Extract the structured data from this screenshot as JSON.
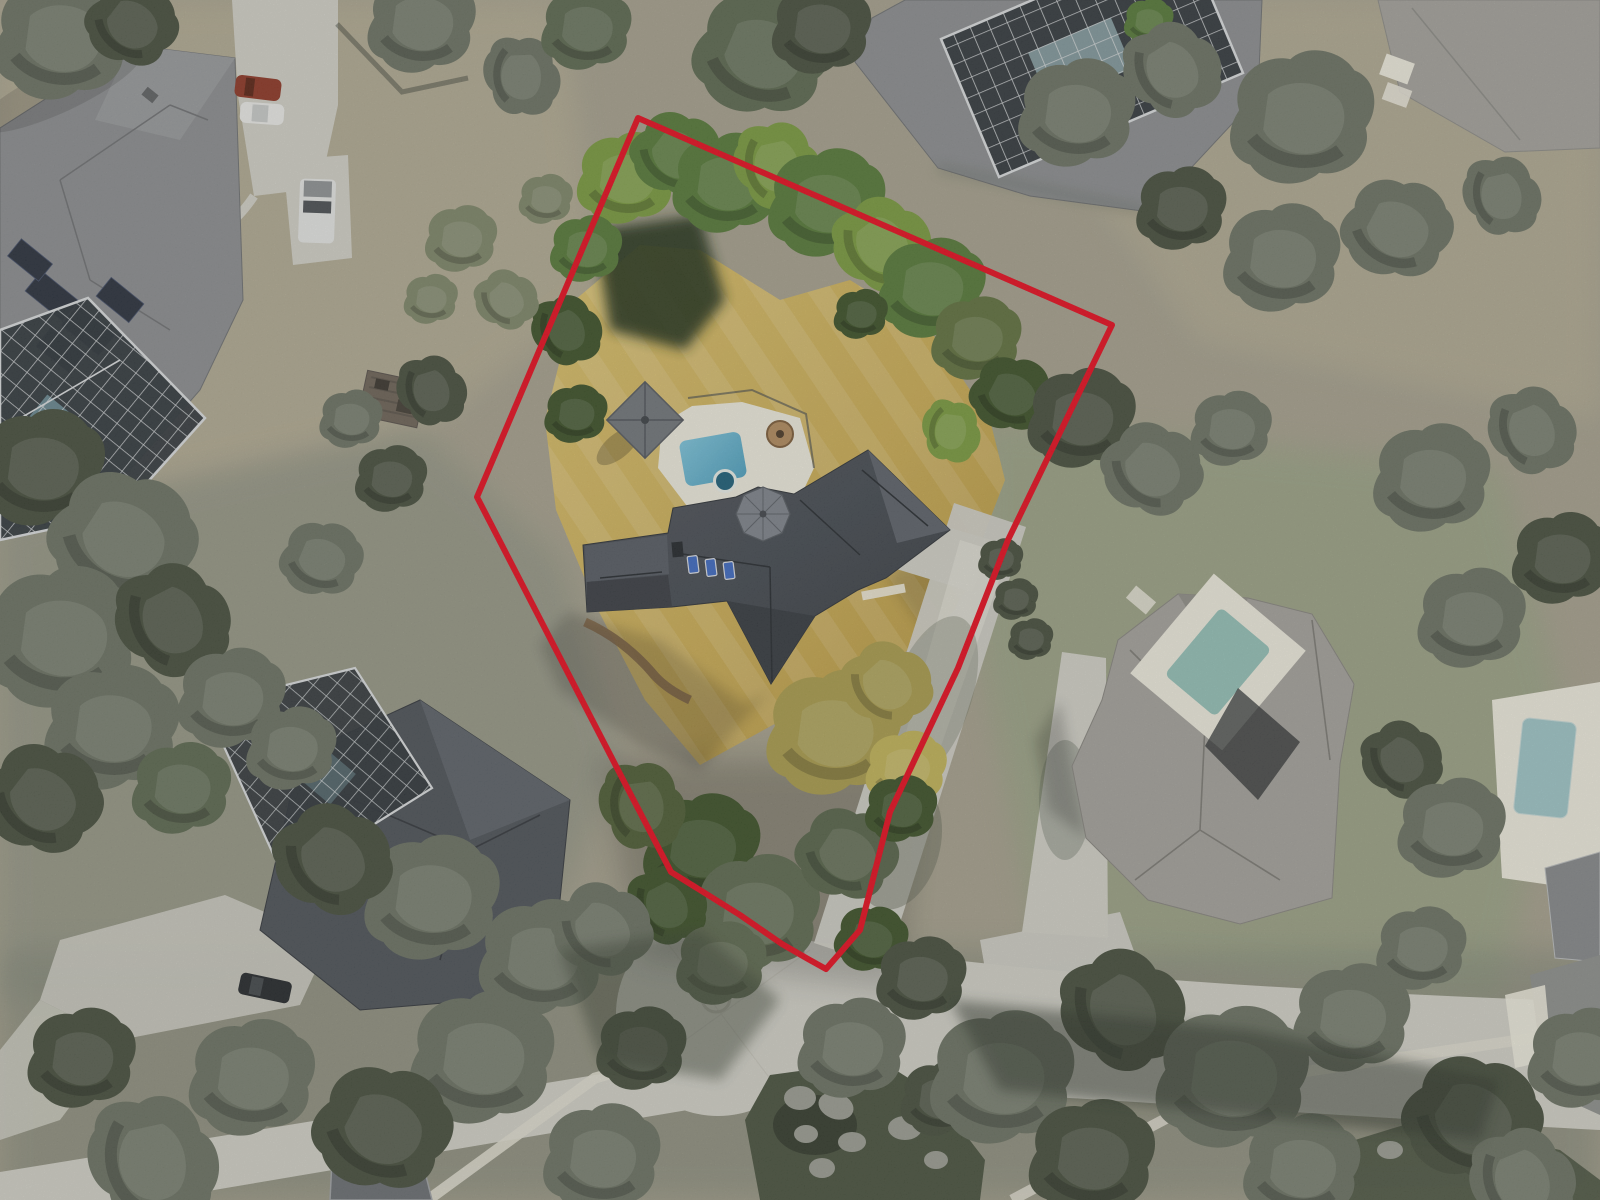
{
  "meta": {
    "description": "Aerial drone photo of a wooded residential neighborhood with a red outline marking the boundary of a large irregular lot containing a dark-shingle-roof house, swimming pool with white deck, gazebo and dried golden lawn; neighboring estates with pool screen enclosures, a concrete cul-de-sac street below, and heavy tree canopy throughout."
  },
  "boundary": {
    "label": "subject-parcel-outline",
    "color": "#e50d20",
    "stroke_width": 6,
    "path": "M 638 118 L 1112 325 L 1008 540 L 958 668 L 890 812 L 860 930 L 826 969 L 808 959 L 782 944 L 740 915 L 700 890 L 671 872 L 617 768 L 477 497 Z"
  },
  "scene": {
    "subject_lot": [
      "dark gray shingle house with turret and three blue skylights",
      "rectangular pool with dark spa on white deck",
      "gray pyramid-roof gazebo",
      "round paver fire pit",
      "dried golden lawn with mow stripes",
      "green tree band along north boundary",
      "autumn and evergreen trees at south of lot",
      "concrete driveway along east boundary to cul-de-sac"
    ],
    "neighbors": [
      "top-left estate with solar panels and screened pool cage, red car, white car, white truck on driveway",
      "top-center house with large glass/screen pool enclosure",
      "top-right corner large gray roof",
      "right estate with tile roof and teal courtyard pool, long driveway",
      "far-right pool with white deck",
      "bottom-left house with screened pool cage and dark car",
      "bottom-edge roof corner"
    ],
    "street": [
      "concrete cul-de-sac with painted center circle",
      "road exiting right under tree canopy",
      "road exiting lower-left",
      "white sidewalks",
      "rock landscape bed with boulders",
      "black mailbox bin",
      "street lamp"
    ]
  },
  "colors": {
    "base_grass": "#a5a08d",
    "grass_tan": "#b3ab93",
    "grass_sage": "#9aa285",
    "grass_shade": "#8f9383",
    "lawn_gold": "#c9ab55",
    "lawn_gold_light": "#d9c06c",
    "lawn_gold_dark": "#b3943f",
    "tree_gray": "#6b7263",
    "tree_dark": "#474f3e",
    "tree_mid": "#5c6850",
    "tree_lush": "#567839",
    "tree_bright": "#79993f",
    "tree_dkgreen": "#3c5129",
    "tree_autumn": "#a89b4d",
    "tree_autumn_light": "#c0b258",
    "palm_green": "#7d8568",
    "concrete": "#d0cfc6",
    "concrete_bright": "#e5e3d9",
    "sidewalk": "#dedbce",
    "deck_white": "#ece9dc",
    "roof_dark": "#43484f",
    "roof_dark2": "#4d5258",
    "roof_gray": "#8b8d8f",
    "roof_gray_light": "#a3a19b",
    "turret_gray": "#7e838b",
    "screen_dark": "#30363b",
    "cage_line": "#d9dcdd",
    "pool_blue": "#7cc3da",
    "pool_blue_deep": "#4f9fbd",
    "pool_teal": "#93bfb6",
    "pool_pale": "#9dc4c6",
    "spa_dark": "#1f5f78",
    "skylight_blue": "#3f69c0",
    "solar_dark": "#2a313d",
    "boundary_red": "#e50d20",
    "car_red": "#8d3726",
    "car_white": "#e8e8e6",
    "car_dark": "#26292c",
    "mulch": "#8a6d4a",
    "rock_gray": "#9a9c92",
    "bed_dark": "#49523f",
    "shadow_dark": "#20261d"
  }
}
